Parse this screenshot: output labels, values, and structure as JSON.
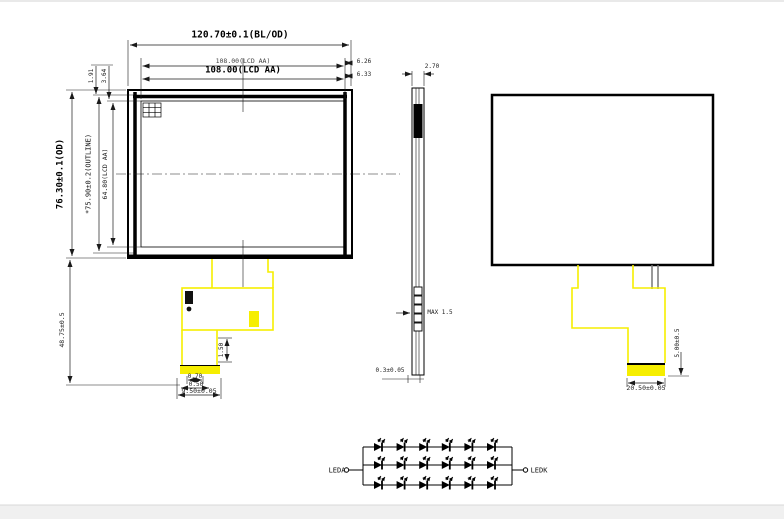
{
  "drawing": {
    "front_view": {
      "dims": {
        "bl_od_width": "120.70±0.1(BL/OD)",
        "lcd_aa_width_top": "108.00(LCD AA)",
        "lcd_aa_width": "108.00(LCD AA)",
        "right_offset_top": "6.26",
        "right_offset_bottom": "6.33",
        "od_height": "76.30±0.1(OD)",
        "outline_height": "*75.90±0.2(OUTLINE)",
        "lcd_aa_height": "64.80(LCD AA)",
        "top_gap_inner": "1.91",
        "top_gap_outer": "3.64",
        "fpc_length": "48.75±0.5",
        "fpc_neck": "1.50",
        "pad_width": "0.70",
        "pad_pitch": "0.50",
        "connector_width": "9.50±0.05"
      }
    },
    "side_view": {
      "dims": {
        "thickness": "2.70",
        "fpc_max_thickness": "MAX 1.5",
        "bottom_step": "0.3±0.05"
      }
    },
    "back_view": {
      "dims": {
        "connector_height": "5.00±0.5",
        "connector_width": "20.50±0.05"
      }
    },
    "led_circuit": {
      "anode_label": "LEDA",
      "cathode_label": "LEDK",
      "rows": 3,
      "leds_per_row": 6
    },
    "colors": {
      "fpc_yellow": "#f6ee00",
      "line": "#000000"
    }
  }
}
